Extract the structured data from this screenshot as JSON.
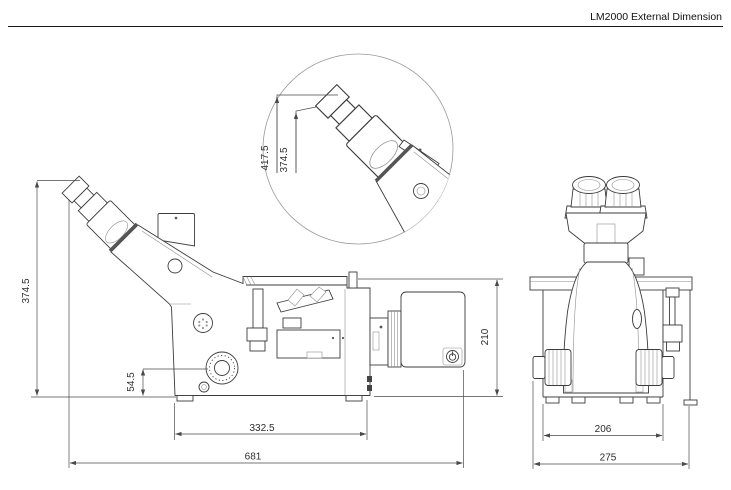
{
  "title": "LM2000 External Dimension",
  "dimensions": {
    "detail_eyepoint_high": "417.5",
    "detail_eyepoint_low": "374.5",
    "overall_height": "374.5",
    "focus_knob_height": "54.5",
    "base_length": "332.5",
    "overall_length": "681",
    "illuminator_height": "210",
    "front_base_width": "206",
    "overall_width": "275"
  },
  "colors": {
    "outline": "#3c3c3c",
    "secondary": "#8f8f8f",
    "dimension": "#4a4a4a",
    "background": "#ffffff"
  }
}
